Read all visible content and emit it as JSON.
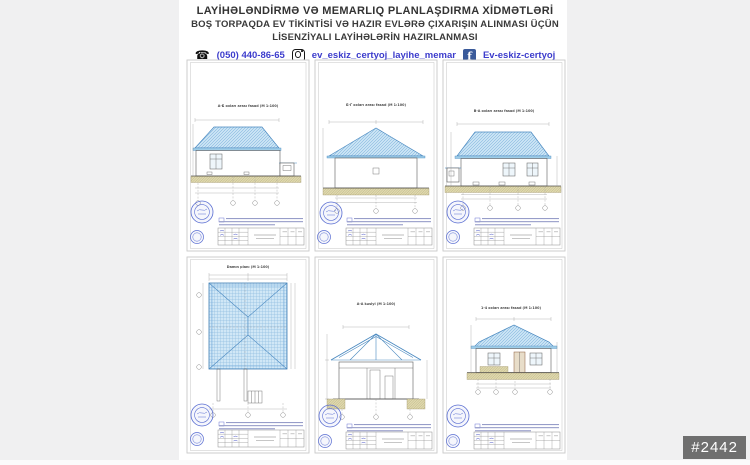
{
  "header": {
    "line1": "LAYİHƏLƏNDİRMƏ VƏ MEMARLIQ PLANLAŞDIRMA XİDMƏTLƏRİ",
    "line2": "BOŞ TORPAQDA EV TİKİNTİSİ VƏ HAZIR EVLƏRƏ ÇIXARIŞIN ALINMASI ÜÇÜN",
    "line3": "LİSENZİYALI LAYİHƏLƏRİN HAZIRLANMASI",
    "contact": {
      "phone_icon": "☎",
      "phone": "(050) 440-86-65",
      "instagram_handle": "ev_eskiz_certyoj_layihe_memar",
      "facebook_icon_letter": "f",
      "facebook_name": "Ev-eskiz-certyoj"
    }
  },
  "sheets": [
    {
      "id": "facade-a-b",
      "title": "A-Б oxları arası fasad (M 1:100)"
    },
    {
      "id": "facade-b-q",
      "title": "Б-Г oxları arası fasad (M 1:100)"
    },
    {
      "id": "facade-v-a",
      "title": "В-А oxları arası fasad (M 1:100)"
    },
    {
      "id": "roof-plan",
      "title": "Damın planı (M 1:100)"
    },
    {
      "id": "section-a-a",
      "title": "A-A kəsiyi (M 1:100)"
    },
    {
      "id": "facade-1-4",
      "title": "1-4 oxları arası fasad (M 1:100)"
    }
  ],
  "badge": "#2442",
  "colors": {
    "link_blue": "#3c3ccc",
    "roof_fill": "#c9e3f4",
    "roof_edge": "#4a89c0",
    "ground_tan": "#dfd8ad",
    "stamp_blue": "#5a6ed2",
    "badge_bg": "#6f6f6f",
    "facebook_blue": "#3a5a9a"
  }
}
